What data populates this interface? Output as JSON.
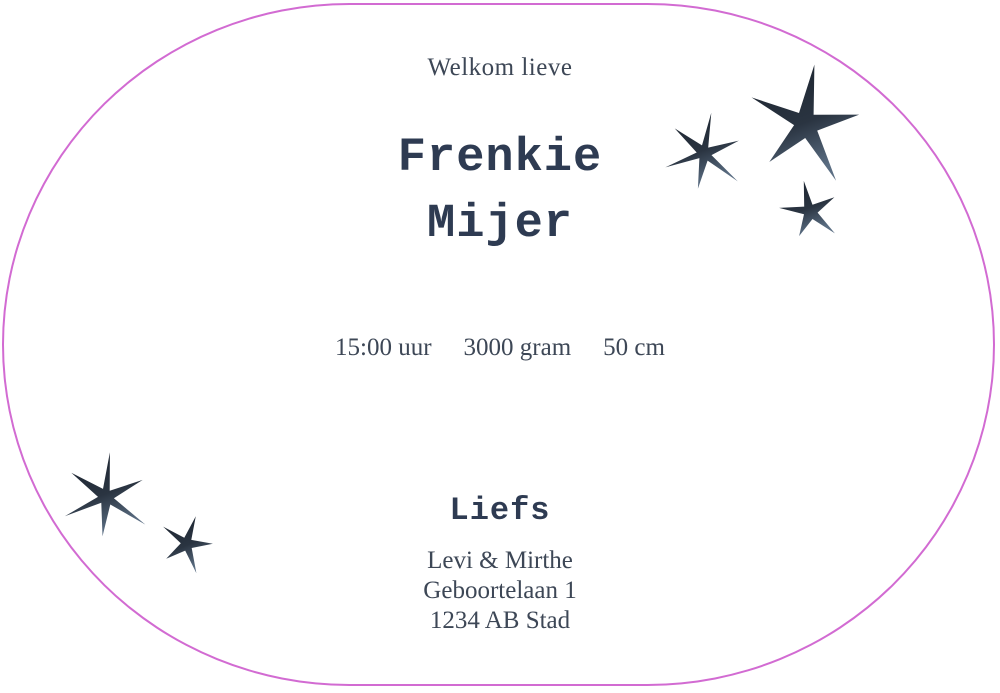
{
  "card": {
    "background": "#ffffff",
    "border_color": "#d26bd2",
    "text_color": "#3d4756",
    "name_color": "#2e3b52",
    "greeting": "Welkom lieve",
    "name_line1": "Frenkie",
    "name_line2": "Mijer",
    "stats": [
      "15:00 uur",
      "3000 gram",
      "50 cm"
    ],
    "closing": "Liefs",
    "address": [
      "Levi & Mirthe",
      "Geboortelaan 1",
      "1234 AB Stad"
    ]
  },
  "decorations": {
    "star_color": "#2a3441",
    "star_color_dark": "#1b232e",
    "star_color_light": "#5b6e83",
    "stars": [
      {
        "name": "star-top-right-medium",
        "cx": 704,
        "cy": 153,
        "points": 6,
        "outer": 41,
        "inner": 7.5,
        "rotation": 10
      },
      {
        "name": "star-top-right-large",
        "cx": 806,
        "cy": 124,
        "points": 5,
        "outer": 60,
        "inner": 13,
        "rotation": 8
      },
      {
        "name": "star-top-right-small",
        "cx": 810,
        "cy": 211,
        "points": 5,
        "outer": 31,
        "inner": 7.5,
        "rotation": -12
      },
      {
        "name": "star-bottom-left-large",
        "cx": 106,
        "cy": 497,
        "points": 6,
        "outer": 45,
        "inner": 8,
        "rotation": 5
      },
      {
        "name": "star-bottom-left-small",
        "cx": 187,
        "cy": 544,
        "points": 5,
        "outer": 29,
        "inner": 6.5,
        "rotation": 18
      }
    ]
  }
}
